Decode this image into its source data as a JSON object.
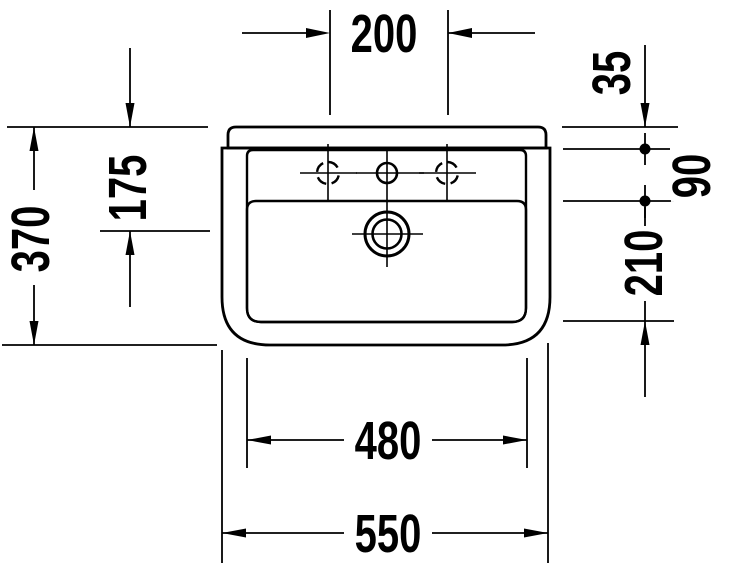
{
  "drawing": {
    "dims": {
      "tap_spacing": "200",
      "overall_depth": "370",
      "drain_from_rear": "175",
      "rear_rim": "35",
      "rim_to_bowl": "90",
      "bowl_front": "210",
      "inner_width": "480",
      "overall_width": "550"
    },
    "colors": {
      "line": "#000000",
      "background": "#ffffff"
    }
  }
}
